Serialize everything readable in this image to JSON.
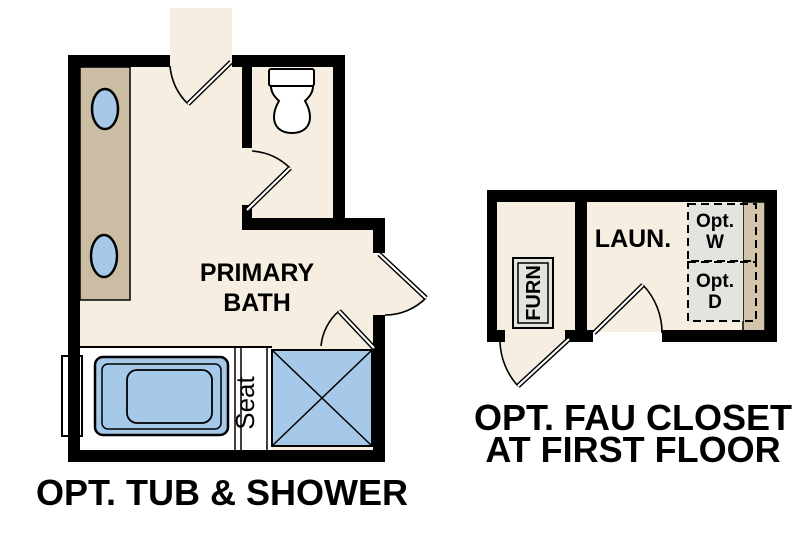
{
  "colors": {
    "wall": "#000000",
    "floor": "#f5eee1",
    "counter": "#cbbda3",
    "cabinet": "#d3c5ac",
    "fixture": "#a6c9e9",
    "appliance": "#e3e3e0",
    "paper": "#ffffff",
    "line": "#000000",
    "text": "#000000"
  },
  "primary_bath": {
    "room_label_line1": "PRIMARY",
    "room_label_line2": "BATH",
    "seat_label": "Seat",
    "caption": "OPT. TUB & SHOWER"
  },
  "fau_closet": {
    "room_label": "LAUN.",
    "furnace_label": "FURN",
    "washer_line1": "Opt.",
    "washer_line2": "W",
    "dryer_line1": "Opt.",
    "dryer_line2": "D",
    "caption_line1": "OPT. FAU CLOSET",
    "caption_line2": "AT FIRST FLOOR"
  }
}
